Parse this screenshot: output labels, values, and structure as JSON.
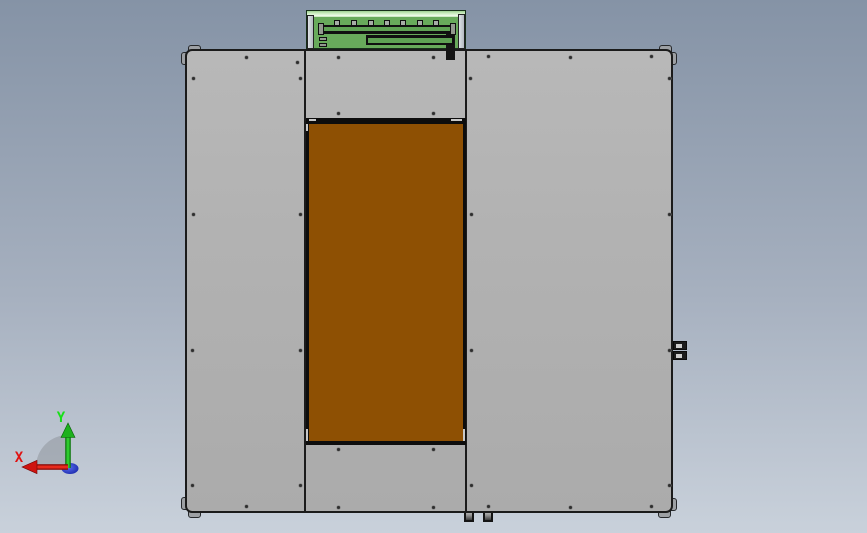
{
  "viewport": {
    "triad": {
      "x_label": "X",
      "y_label": "Y"
    }
  },
  "colors": {
    "background_top": "#8593a6",
    "background_bottom": "#c9d1db",
    "enclosure_gray": "#b2b2b2",
    "outline_black": "#1b1b1b",
    "door_brown": "#8e5003",
    "feeder_green": "#68aa5b",
    "feeder_rail_green": "#5fa254",
    "axis_x_red": "#e01010",
    "axis_y_green": "#1ec41e",
    "axis_z_blue": "#2438c8"
  },
  "machine": {
    "screws": [
      [
        246,
        57
      ],
      [
        297,
        62
      ],
      [
        338,
        57
      ],
      [
        433,
        57
      ],
      [
        488,
        56
      ],
      [
        570,
        57
      ],
      [
        651,
        56
      ],
      [
        193,
        78
      ],
      [
        300,
        78
      ],
      [
        470,
        78
      ],
      [
        669,
        78
      ],
      [
        338,
        113
      ],
      [
        433,
        113
      ],
      [
        193,
        214
      ],
      [
        300,
        214
      ],
      [
        471,
        214
      ],
      [
        669,
        214
      ],
      [
        192,
        350
      ],
      [
        300,
        350
      ],
      [
        471,
        350
      ],
      [
        669,
        350
      ],
      [
        338,
        449
      ],
      [
        433,
        449
      ],
      [
        192,
        485
      ],
      [
        300,
        485
      ],
      [
        471,
        485
      ],
      [
        669,
        485
      ],
      [
        246,
        506
      ],
      [
        338,
        507
      ],
      [
        433,
        507
      ],
      [
        488,
        506
      ],
      [
        570,
        507
      ],
      [
        651,
        506
      ]
    ],
    "feeder_tab_x": [
      336,
      353,
      370,
      386,
      402,
      419,
      435
    ]
  }
}
